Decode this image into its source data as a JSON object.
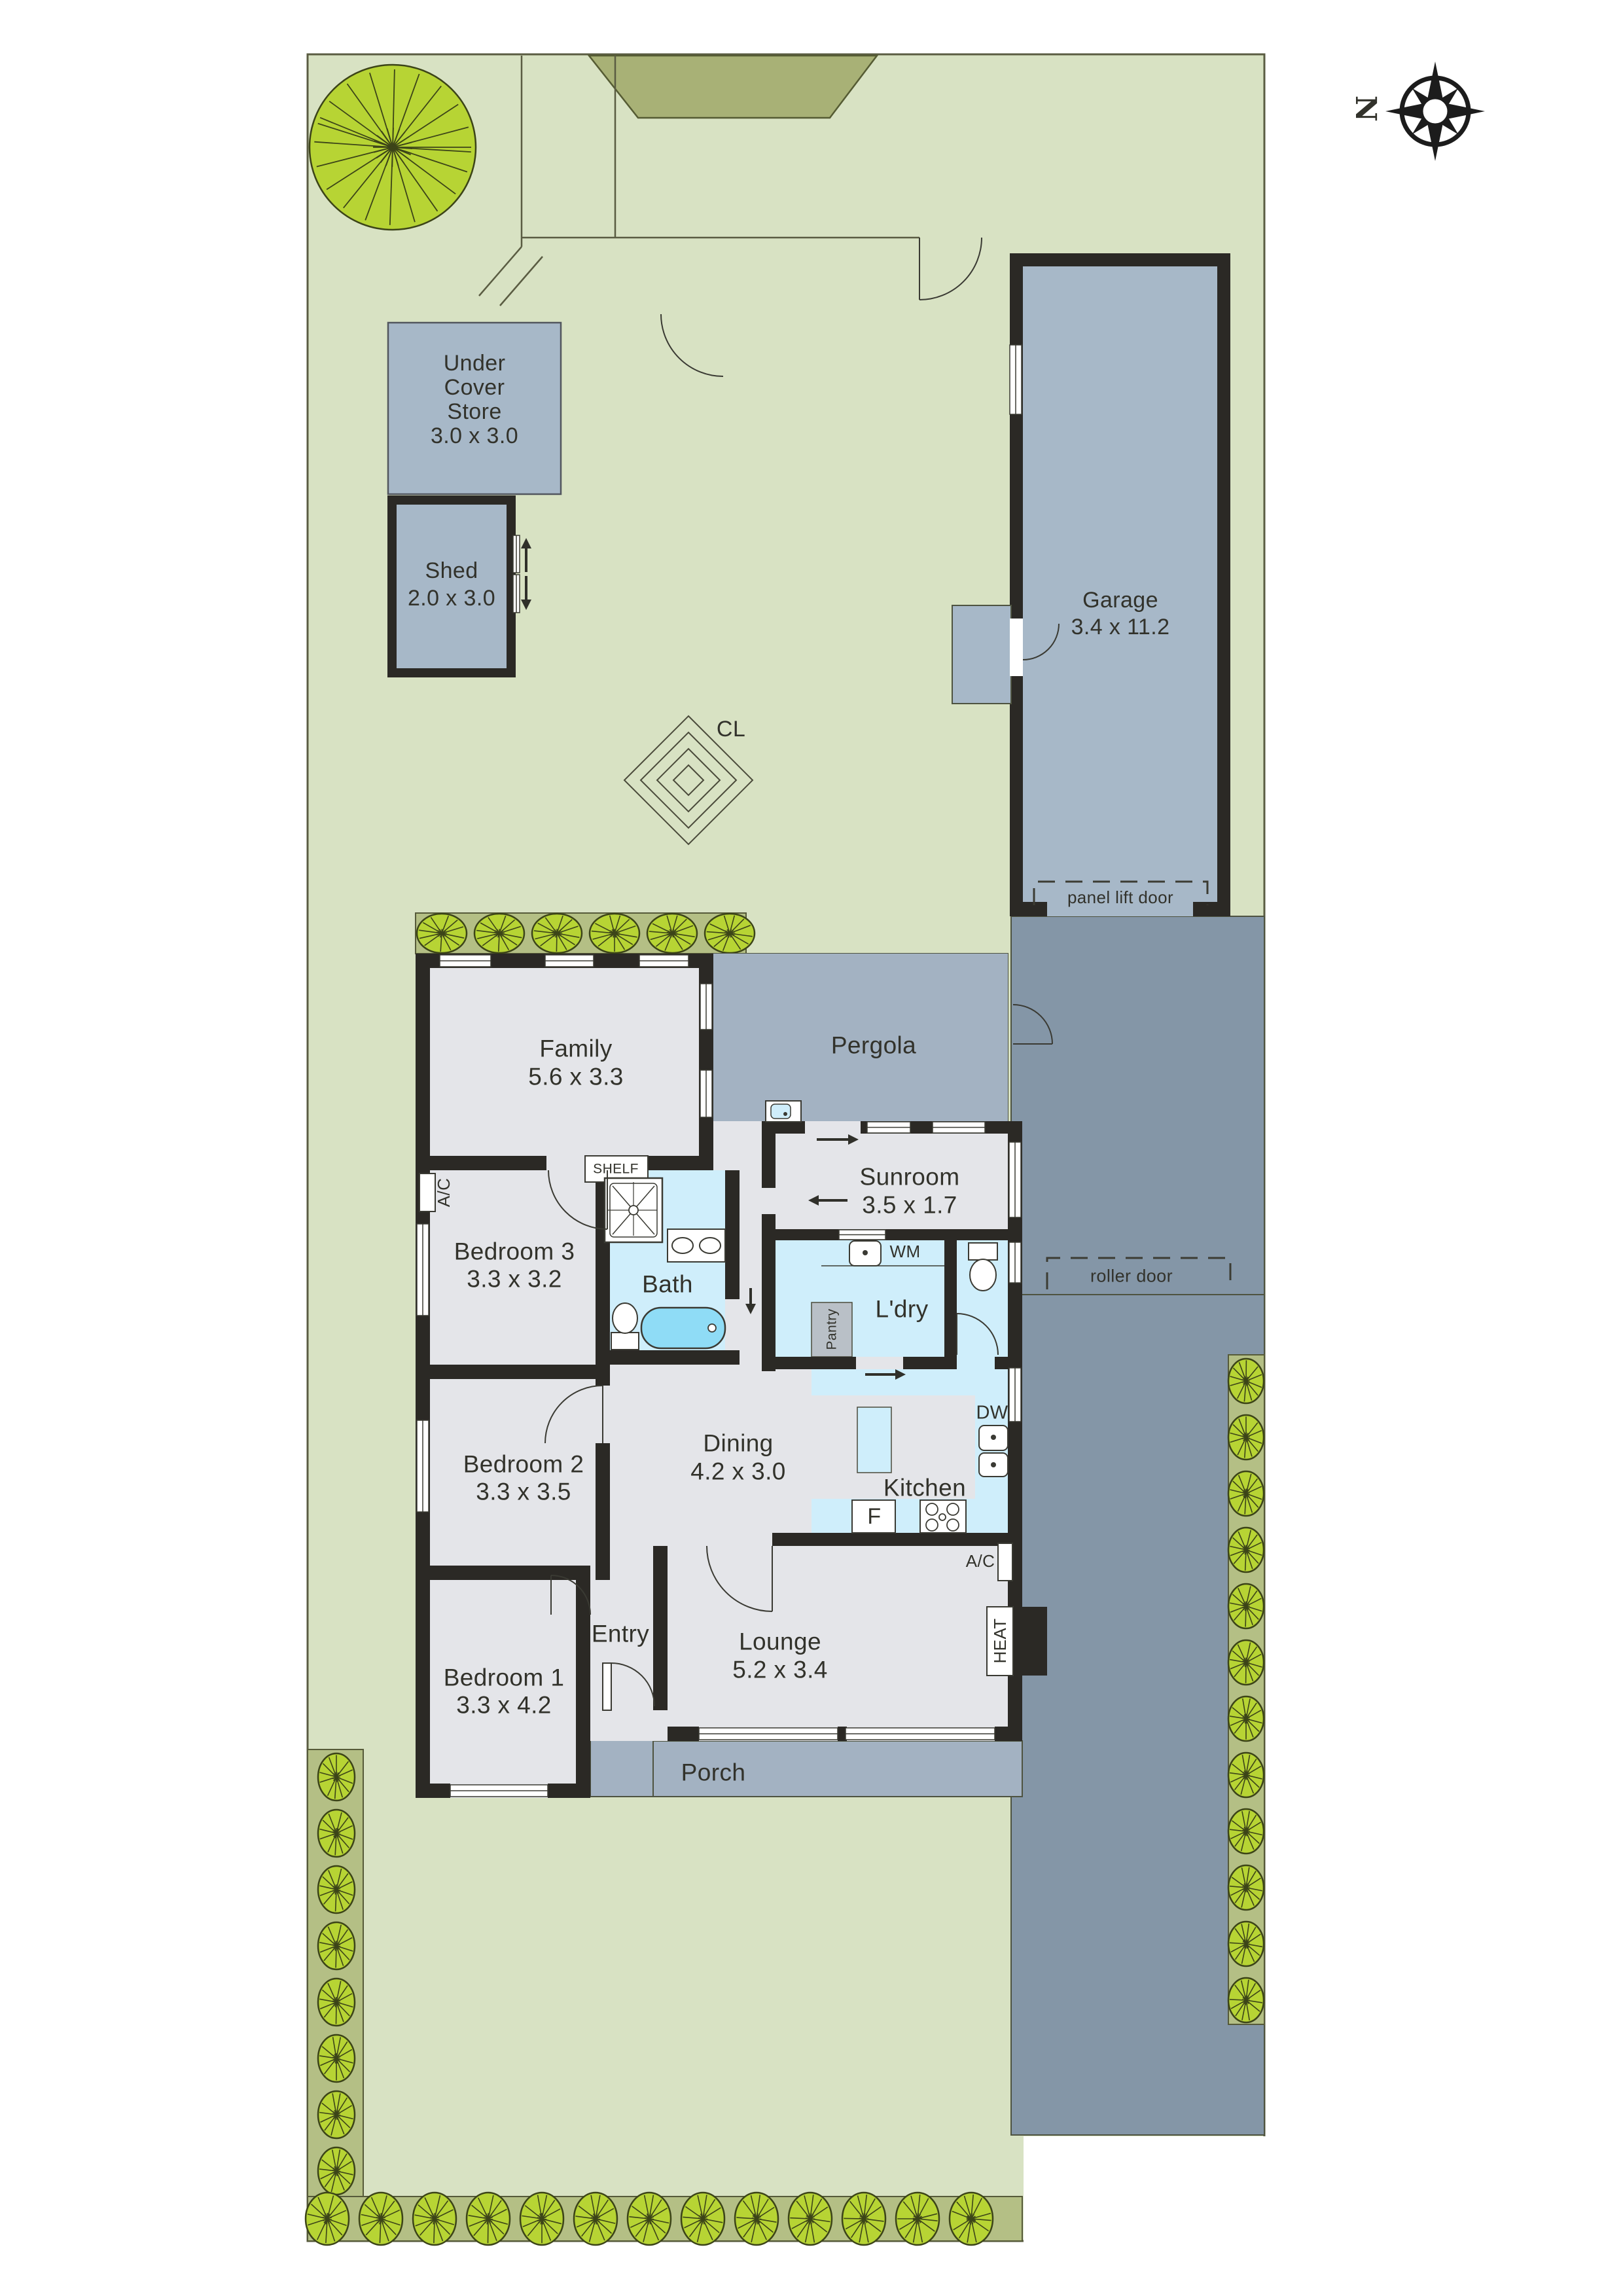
{
  "title": "Residential site and floor plan",
  "palette": {
    "lawn": "#d8e2c3",
    "hedge": "#b4bf85",
    "shrub": "#b7d434",
    "garden_bed": "#a8b176",
    "structure": "#a7b8c8",
    "pergola": "#a3b2c2",
    "driveway": "#8496a7",
    "floor": "#e4e5e9",
    "wet": "#cfeefb",
    "tub": "#8fdcf6",
    "pantry_fill": "#b9c0c7",
    "wall": "#2b2925",
    "line": "#5a5c42",
    "ink": "#32322b"
  },
  "compass": {
    "label": "N"
  },
  "outbuildings": {
    "store": {
      "lines": [
        "Under",
        "Cover",
        "Store",
        "3.0 x 3.0"
      ]
    },
    "shed": {
      "name": "Shed",
      "dims": "2.0 x 3.0"
    },
    "garage": {
      "name": "Garage",
      "dims": "3.4 x 11.2",
      "door_label": "panel lift door"
    }
  },
  "site": {
    "clothesline_label": "CL",
    "roller_door_label": "roller door"
  },
  "rooms": {
    "family": {
      "name": "Family",
      "dims": "5.6 x 3.3"
    },
    "pergola": {
      "name": "Pergola"
    },
    "sunroom": {
      "name": "Sunroom",
      "dims": "3.5 x 1.7"
    },
    "bedroom3": {
      "name": "Bedroom 3",
      "dims": "3.3 x 3.2"
    },
    "bath": {
      "name": "Bath"
    },
    "laundry": {
      "name": "L'dry"
    },
    "bedroom2": {
      "name": "Bedroom 2",
      "dims": "3.3 x 3.5"
    },
    "dining": {
      "name": "Dining",
      "dims": "4.2 x 3.0"
    },
    "kitchen": {
      "name": "Kitchen"
    },
    "bedroom1": {
      "name": "Bedroom 1",
      "dims": "3.3 x 4.2"
    },
    "entry": {
      "name": "Entry"
    },
    "lounge": {
      "name": "Lounge",
      "dims": "5.2 x 3.4"
    },
    "porch": {
      "name": "Porch"
    }
  },
  "fixtures": {
    "wm": "WM",
    "dw": "DW",
    "fridge": "F",
    "pantry": "Pantry",
    "shelf": "SHELF",
    "heat": "HEAT",
    "ac": "A/C"
  }
}
